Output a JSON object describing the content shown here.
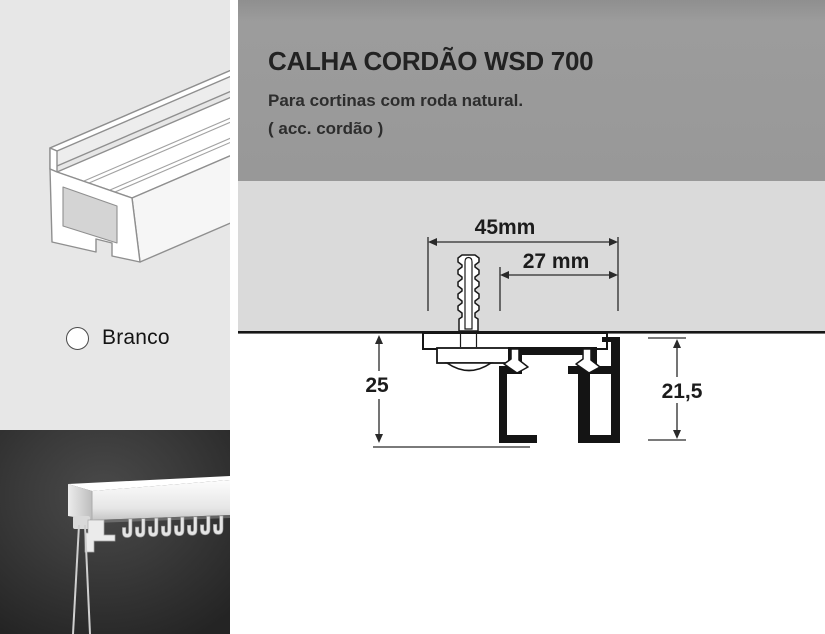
{
  "header": {
    "title": "CALHA CORDÃO WSD 700",
    "subtitle": "Para cortinas com roda natural.",
    "note": "( acc. cordão )"
  },
  "swatch": {
    "label": "Branco",
    "color": "#ffffff"
  },
  "diagram": {
    "dims": {
      "total_width": "45mm",
      "inner_width": "27 mm",
      "total_height": "25",
      "inner_height": "21,5"
    }
  },
  "colors": {
    "header_bg": "#999999",
    "ceiling_bg": "#dadada",
    "left_panel_bg": "#e7e7e7",
    "drawing_ink": "#161616",
    "photo_bg": "#333333"
  }
}
